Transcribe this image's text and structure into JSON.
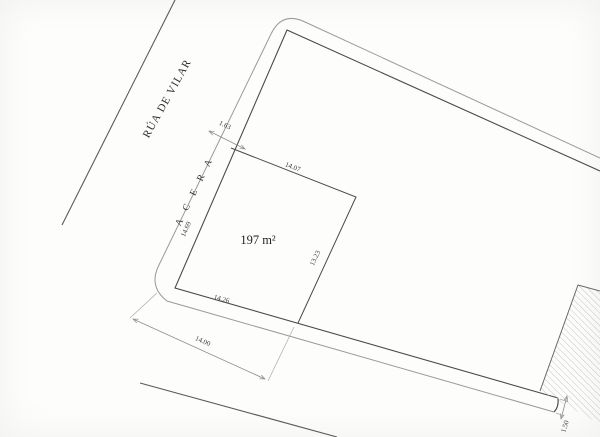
{
  "plan": {
    "street_name": "RÚA DE VILAR",
    "sidewalk_name": "A C E R A",
    "parcel_area": "197 m²",
    "dims": {
      "sidewalk_top_width": "1.63",
      "parcel_top": "14.07",
      "parcel_left": "14.69",
      "parcel_right": "13.23",
      "parcel_bottom": "14.26",
      "frontage": "14.00",
      "sidewalk_bottom_width": "1.50"
    },
    "colors": {
      "block_line": "#4a4a4a",
      "curb_line": "#9a9a9a",
      "dimension_line": "#8f8f8f",
      "hatch": "#b8b8b8",
      "text": "#3c3c3c",
      "background": "#fdfdfc"
    }
  }
}
